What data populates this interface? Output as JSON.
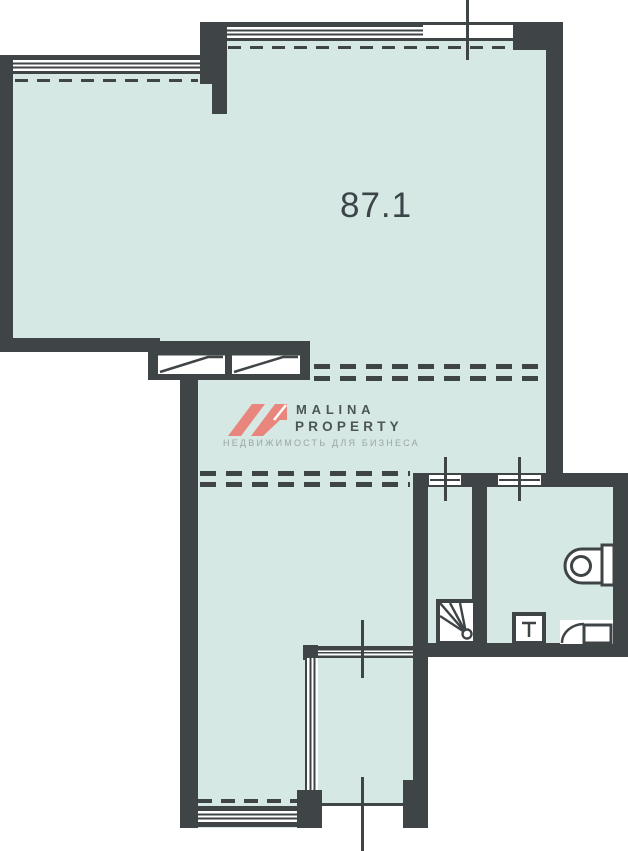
{
  "plan": {
    "area_label": "87.1",
    "watermark": {
      "line1": "MALINA",
      "line2": "PROPERTY",
      "tagline": "НЕДВИЖИМОСТЬ ДЛЯ БИЗНЕСА"
    },
    "icons": {
      "logo_mark": "malina-roof-mark",
      "entrance_doors": "double-door-leaf-icon",
      "shower": "shower-tray-with-drain-icon",
      "washbasin": "washbasin-tap-icon",
      "toilet": "toilet-with-cistern-icon",
      "wc_door": "door-swing-icon",
      "risers": "riser-axis-cross-marks",
      "windows": "glazing-stripe-bands",
      "dashed_lines": "zone-boundary-dashes"
    },
    "colors": {
      "wall": "#3f4447",
      "floor": "#d6e8e3",
      "background": "#ffffff",
      "logo_accent": "#e8857d",
      "logo_text": "#4b5558",
      "tagline_text": "#9aa5a6",
      "area_text": "#3b4549"
    }
  }
}
